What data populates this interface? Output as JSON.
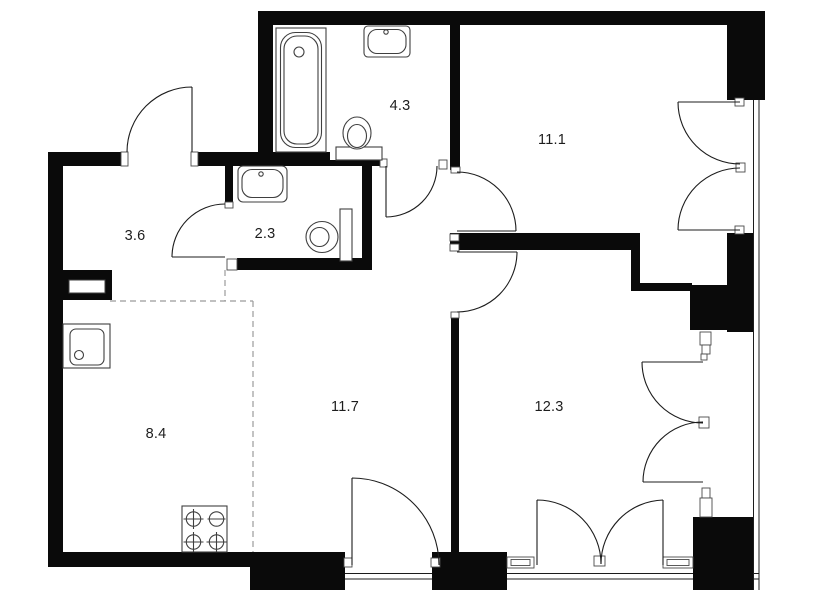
{
  "floor_plan": {
    "background": "#ffffff",
    "wall_color": "#0a0a0a",
    "line_color": "#1c1c1c",
    "fixture_line_color": "#3f3f3f",
    "dash_color": "#9b9b9b",
    "label_color": "#1d1d1d",
    "rooms": [
      {
        "name": "bathroom",
        "area": "4.3"
      },
      {
        "name": "bedroom",
        "area": "11.1"
      },
      {
        "name": "hallway",
        "area": "3.6"
      },
      {
        "name": "wc",
        "area": "2.3"
      },
      {
        "name": "kitchen",
        "area": "8.4"
      },
      {
        "name": "living-room",
        "area": "11.7"
      },
      {
        "name": "bedroom-2",
        "area": "12.3"
      }
    ],
    "fixtures": [
      "bathtub",
      "wall-sink",
      "toilet",
      "wall-sink",
      "toilet",
      "kitchen-sink",
      "stove-4-burner",
      "duct-shaft",
      "pipe-riser",
      "pipe-riser"
    ]
  }
}
